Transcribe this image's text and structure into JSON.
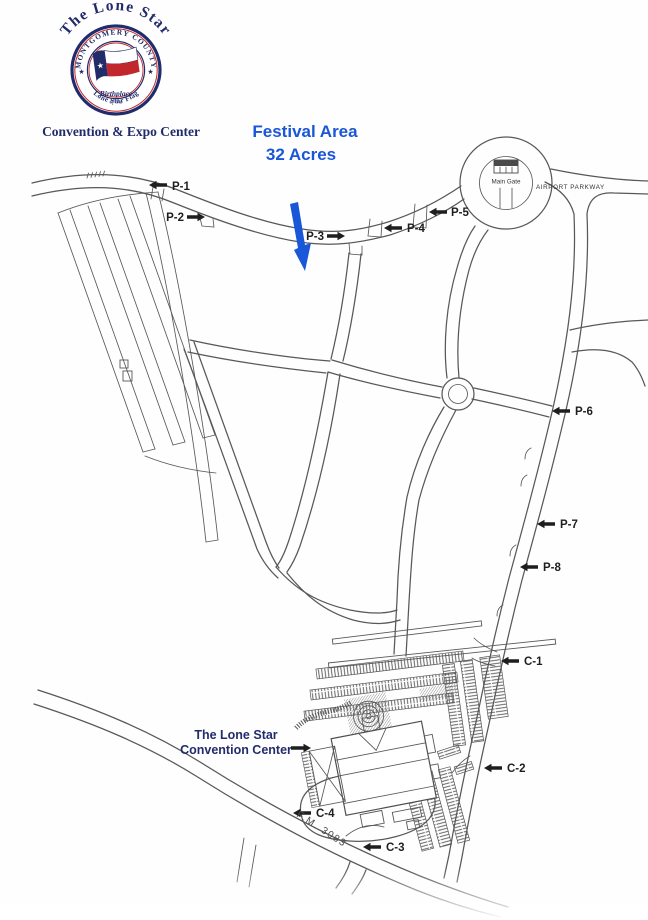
{
  "logo": {
    "arch_text": "The Lone Star",
    "seal_top": "MONTGOMERY COUNTY",
    "seal_bottom": "Lone Star Flag",
    "inner_line1": "Birthplace",
    "inner_line2": "of the",
    "star_glyph": "★",
    "tagline": "Convention & Expo Center"
  },
  "festival": {
    "title": "Festival Area",
    "subtitle": "32 Acres"
  },
  "map_labels": {
    "main_gate": "Main Gate",
    "airport_parkway": "AIRPORT PARKWAY",
    "fm_road": "F.M. 3083",
    "cc_line1": "The Lone Star",
    "cc_line2": "Convention Center"
  },
  "gates": {
    "p1": "P-1",
    "p2": "P-2",
    "p3": "P-3",
    "p4": "P-4",
    "p5": "P-5",
    "p6": "P-6",
    "p7": "P-7",
    "p8": "P-8",
    "c1": "C-1",
    "c2": "C-2",
    "c3": "C-3",
    "c4": "C-4"
  },
  "colors": {
    "navy": "#222c6b",
    "red": "#c1272d",
    "accent_blue": "#1a56d8",
    "road_gray": "#585858",
    "label_black": "#1e1e1e"
  }
}
